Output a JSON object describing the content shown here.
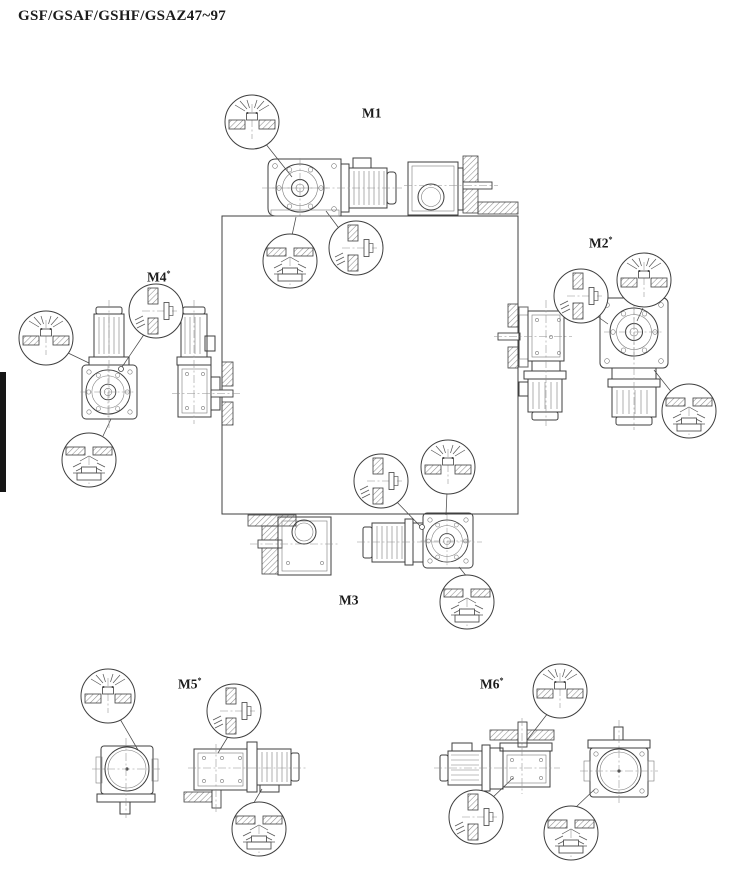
{
  "page": {
    "title": "GSF/GSAF/GSHF/GSAZ47~97"
  },
  "positions": [
    {
      "id": "M1",
      "label": "M1",
      "sup": ""
    },
    {
      "id": "M2",
      "label": "M2",
      "sup": "*"
    },
    {
      "id": "M3",
      "label": "M3",
      "sup": ""
    },
    {
      "id": "M4",
      "label": "M4",
      "sup": "*"
    },
    {
      "id": "M5",
      "label": "M5",
      "sup": "*"
    },
    {
      "id": "M6",
      "label": "M6",
      "sup": "*"
    }
  ],
  "callout_icons": {
    "breather_up": "breather-valve-up-icon",
    "breather_side": "breather-valve-side-icon",
    "drain_plug": "oil-drain-plug-icon"
  },
  "colors": {
    "line": "#3f3f3f",
    "thin_line": "#7b7b7b",
    "leader": "#4a4a4a",
    "edge_tab": "#161616",
    "background": "#ffffff"
  }
}
